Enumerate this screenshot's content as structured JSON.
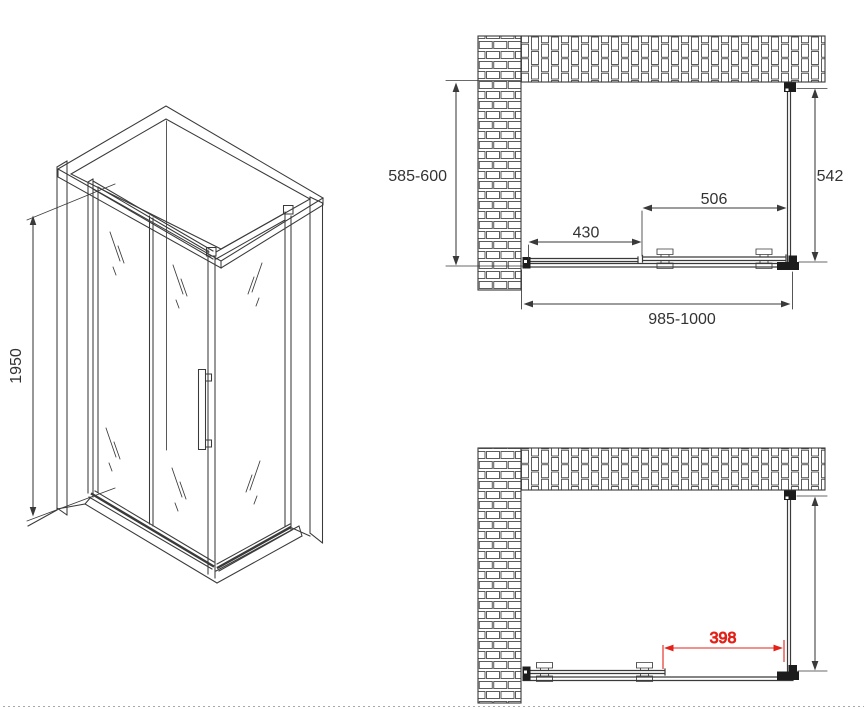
{
  "colors": {
    "line": "#3a3a3a",
    "dimension_red": "#e32119",
    "background": "#ffffff"
  },
  "isometric": {
    "height_mm": "1950"
  },
  "plan_closed": {
    "depth_range_mm": "585-600",
    "side_panel_mm": "542",
    "door_section_mm": "506",
    "fixed_section_mm": "430",
    "width_range_mm": "985-1000"
  },
  "plan_open": {
    "clear_opening_mm": "398"
  }
}
